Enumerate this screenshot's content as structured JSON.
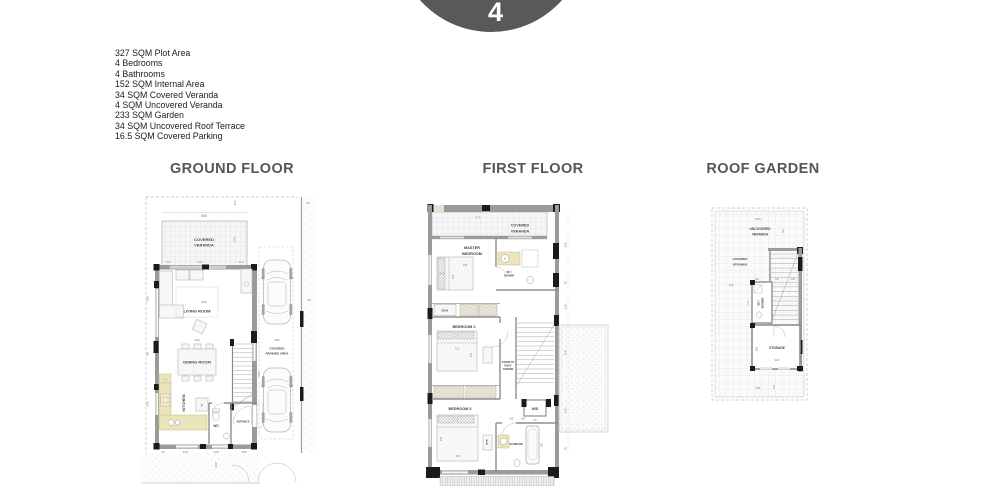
{
  "header": {
    "villa_number": "4"
  },
  "specs": [
    "327 SQM Plot Area",
    "4 Bedrooms",
    "4 Bathrooms",
    "152 SQM Internal Area",
    "34 SQM Covered Veranda",
    "4 SQM Uncovered Veranda",
    "233 SQM Garden",
    "34 SQM Uncovered Roof Terrace",
    "16.5 SQM Covered Parking"
  ],
  "sections": {
    "ground": {
      "title": "GROUND FLOOR",
      "labels": {
        "covered_veranda": [
          "COVERED",
          "VERANDA"
        ],
        "living_room": "LIVING ROOM",
        "dining_room": "DINING ROOM",
        "kitchen": "KITCHEN",
        "wc": "WC",
        "dishwasher": "D/W",
        "fridge": "F",
        "parking": [
          "COVERED",
          "PARKING AREA"
        ],
        "entrance": "ENTRANCE"
      },
      "dims": {
        "plot_top": "505",
        "veranda_width": "600",
        "veranda_right": "123",
        "veranda_left": "50",
        "veranda_height": "308",
        "side_top": "115",
        "living_width": "520",
        "living_inner": "420",
        "left_upper": "400",
        "left_mid": "90",
        "left_lower": "430",
        "stairs": "500",
        "bottom": [
          "93",
          "140",
          "218",
          "100"
        ],
        "garden": "260",
        "parking_length": "290",
        "fence_top": "50",
        "fence_mid": "60"
      }
    },
    "first": {
      "title": "FIRST FLOOR",
      "labels": {
        "covered_veranda": [
          "COVERED",
          "VERANDA"
        ],
        "master_bedroom": [
          "MASTER",
          "BEDROOM"
        ],
        "ensuite": [
          "WC /",
          "SHOWER"
        ],
        "bedroom2": "BEDROOM 2",
        "bedroom3": "BEDROOM 3",
        "stairs_note": [
          "STAIRS TO",
          "ROOF",
          "GARDEN"
        ],
        "laundry": "W/D",
        "bathroom": "BATHROOM",
        "desk": "DESK"
      },
      "dims": {
        "top": "575",
        "right": [
          "265",
          "70",
          "230",
          "258",
          "346",
          "70"
        ],
        "master_bed_w": "325",
        "master_bed_h": "335",
        "bed2_w": "310",
        "bed2_h": "300",
        "bed3_w": "310",
        "bed3_h": "320",
        "hall": "145",
        "hall2": "100",
        "laundry_w": "60",
        "bath": "200"
      }
    },
    "roof": {
      "title": "ROOF GARDEN",
      "labels": {
        "uncovered_veranda": [
          "UNCOVERED",
          "VERANDA"
        ],
        "covered_veranda": [
          "COVERED",
          "VERANDA"
        ],
        "wc_shower": [
          "WC /",
          "SHOWER"
        ],
        "storage": "STORAGE"
      },
      "dims": {
        "top": "660",
        "side": "95",
        "left": "206",
        "wc_row": [
          "100",
          "100",
          "100"
        ],
        "wc_height": "170",
        "storage_height": "300",
        "storage_width": "223",
        "bottom": "560",
        "bottom_side": "120"
      }
    }
  },
  "colors": {
    "badge": "#58595b",
    "titles": "#55565a",
    "wall_fill": "#9b9b9b",
    "wall_black": "#1b1b1b",
    "counter_yellow": "#ebe5bb",
    "dim_text": "#6f6f6f"
  }
}
